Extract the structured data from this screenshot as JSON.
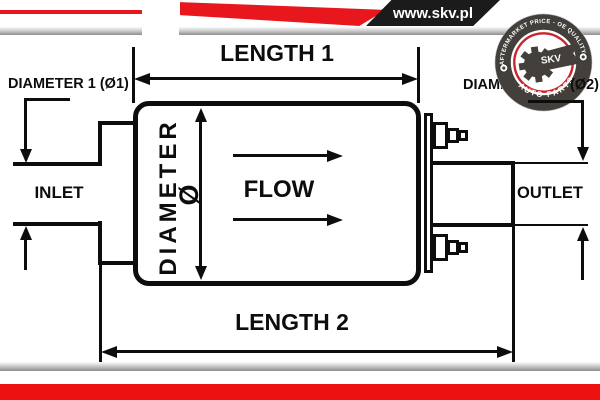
{
  "header": {
    "website": "www.skv.pl",
    "badge": {
      "arc_top": "AFTERMARKET PRICE - OE QUALITY",
      "arc_bottom": "AUTO PARTS",
      "brand": "SKV"
    }
  },
  "diagram": {
    "length1": "LENGTH 1",
    "length2": "LENGTH 2",
    "diameter1": "DIAMETER 1 (Ø1)",
    "diameter2_main": "DIAMETER 2",
    "diameter2_suffix": "(Ø2)",
    "diameter_vertical": "DIAMETER",
    "diameter_symbol": "Ø",
    "inlet": "INLET",
    "outlet": "OUTLET",
    "flow": "FLOW"
  },
  "colors": {
    "line": "#0d0d0d",
    "header_red": "#e8161d",
    "header_black": "#1b1b1b",
    "footer_red": "#ee1111",
    "badge_dark": "#433f3b",
    "badge_red_ring": "#c8252c"
  }
}
